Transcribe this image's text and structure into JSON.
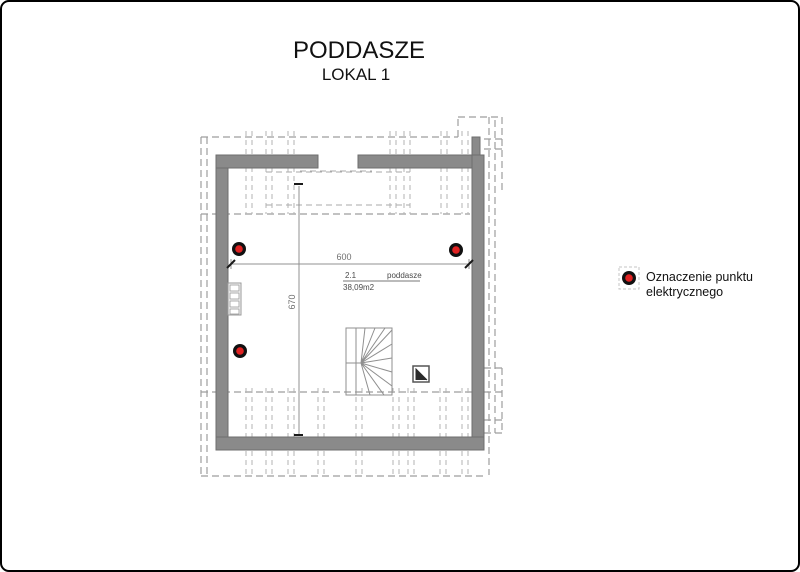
{
  "page": {
    "title": "PODDASZE",
    "subtitle": "LOKAL 1"
  },
  "plan": {
    "room": {
      "number": "2.1",
      "name": "poddasze",
      "area": "38,09m2"
    },
    "dimensions": {
      "width": "600",
      "height": "670"
    },
    "electrical_points": [
      {
        "x": 239,
        "y": 249
      },
      {
        "x": 456,
        "y": 250
      },
      {
        "x": 240,
        "y": 351
      }
    ]
  },
  "legend": {
    "symbol": "electrical-point",
    "label_line1": "Oznaczenie punktu",
    "label_line2": "elektrycznego"
  },
  "colors": {
    "electrical_red": "#e02222",
    "marker_ring": "#111111",
    "wall": "#8a8a8a",
    "wall_outline": "#6e6e6e",
    "dash": "#9e9e9e",
    "text_dark": "#111111",
    "dim_text": "#707070"
  }
}
